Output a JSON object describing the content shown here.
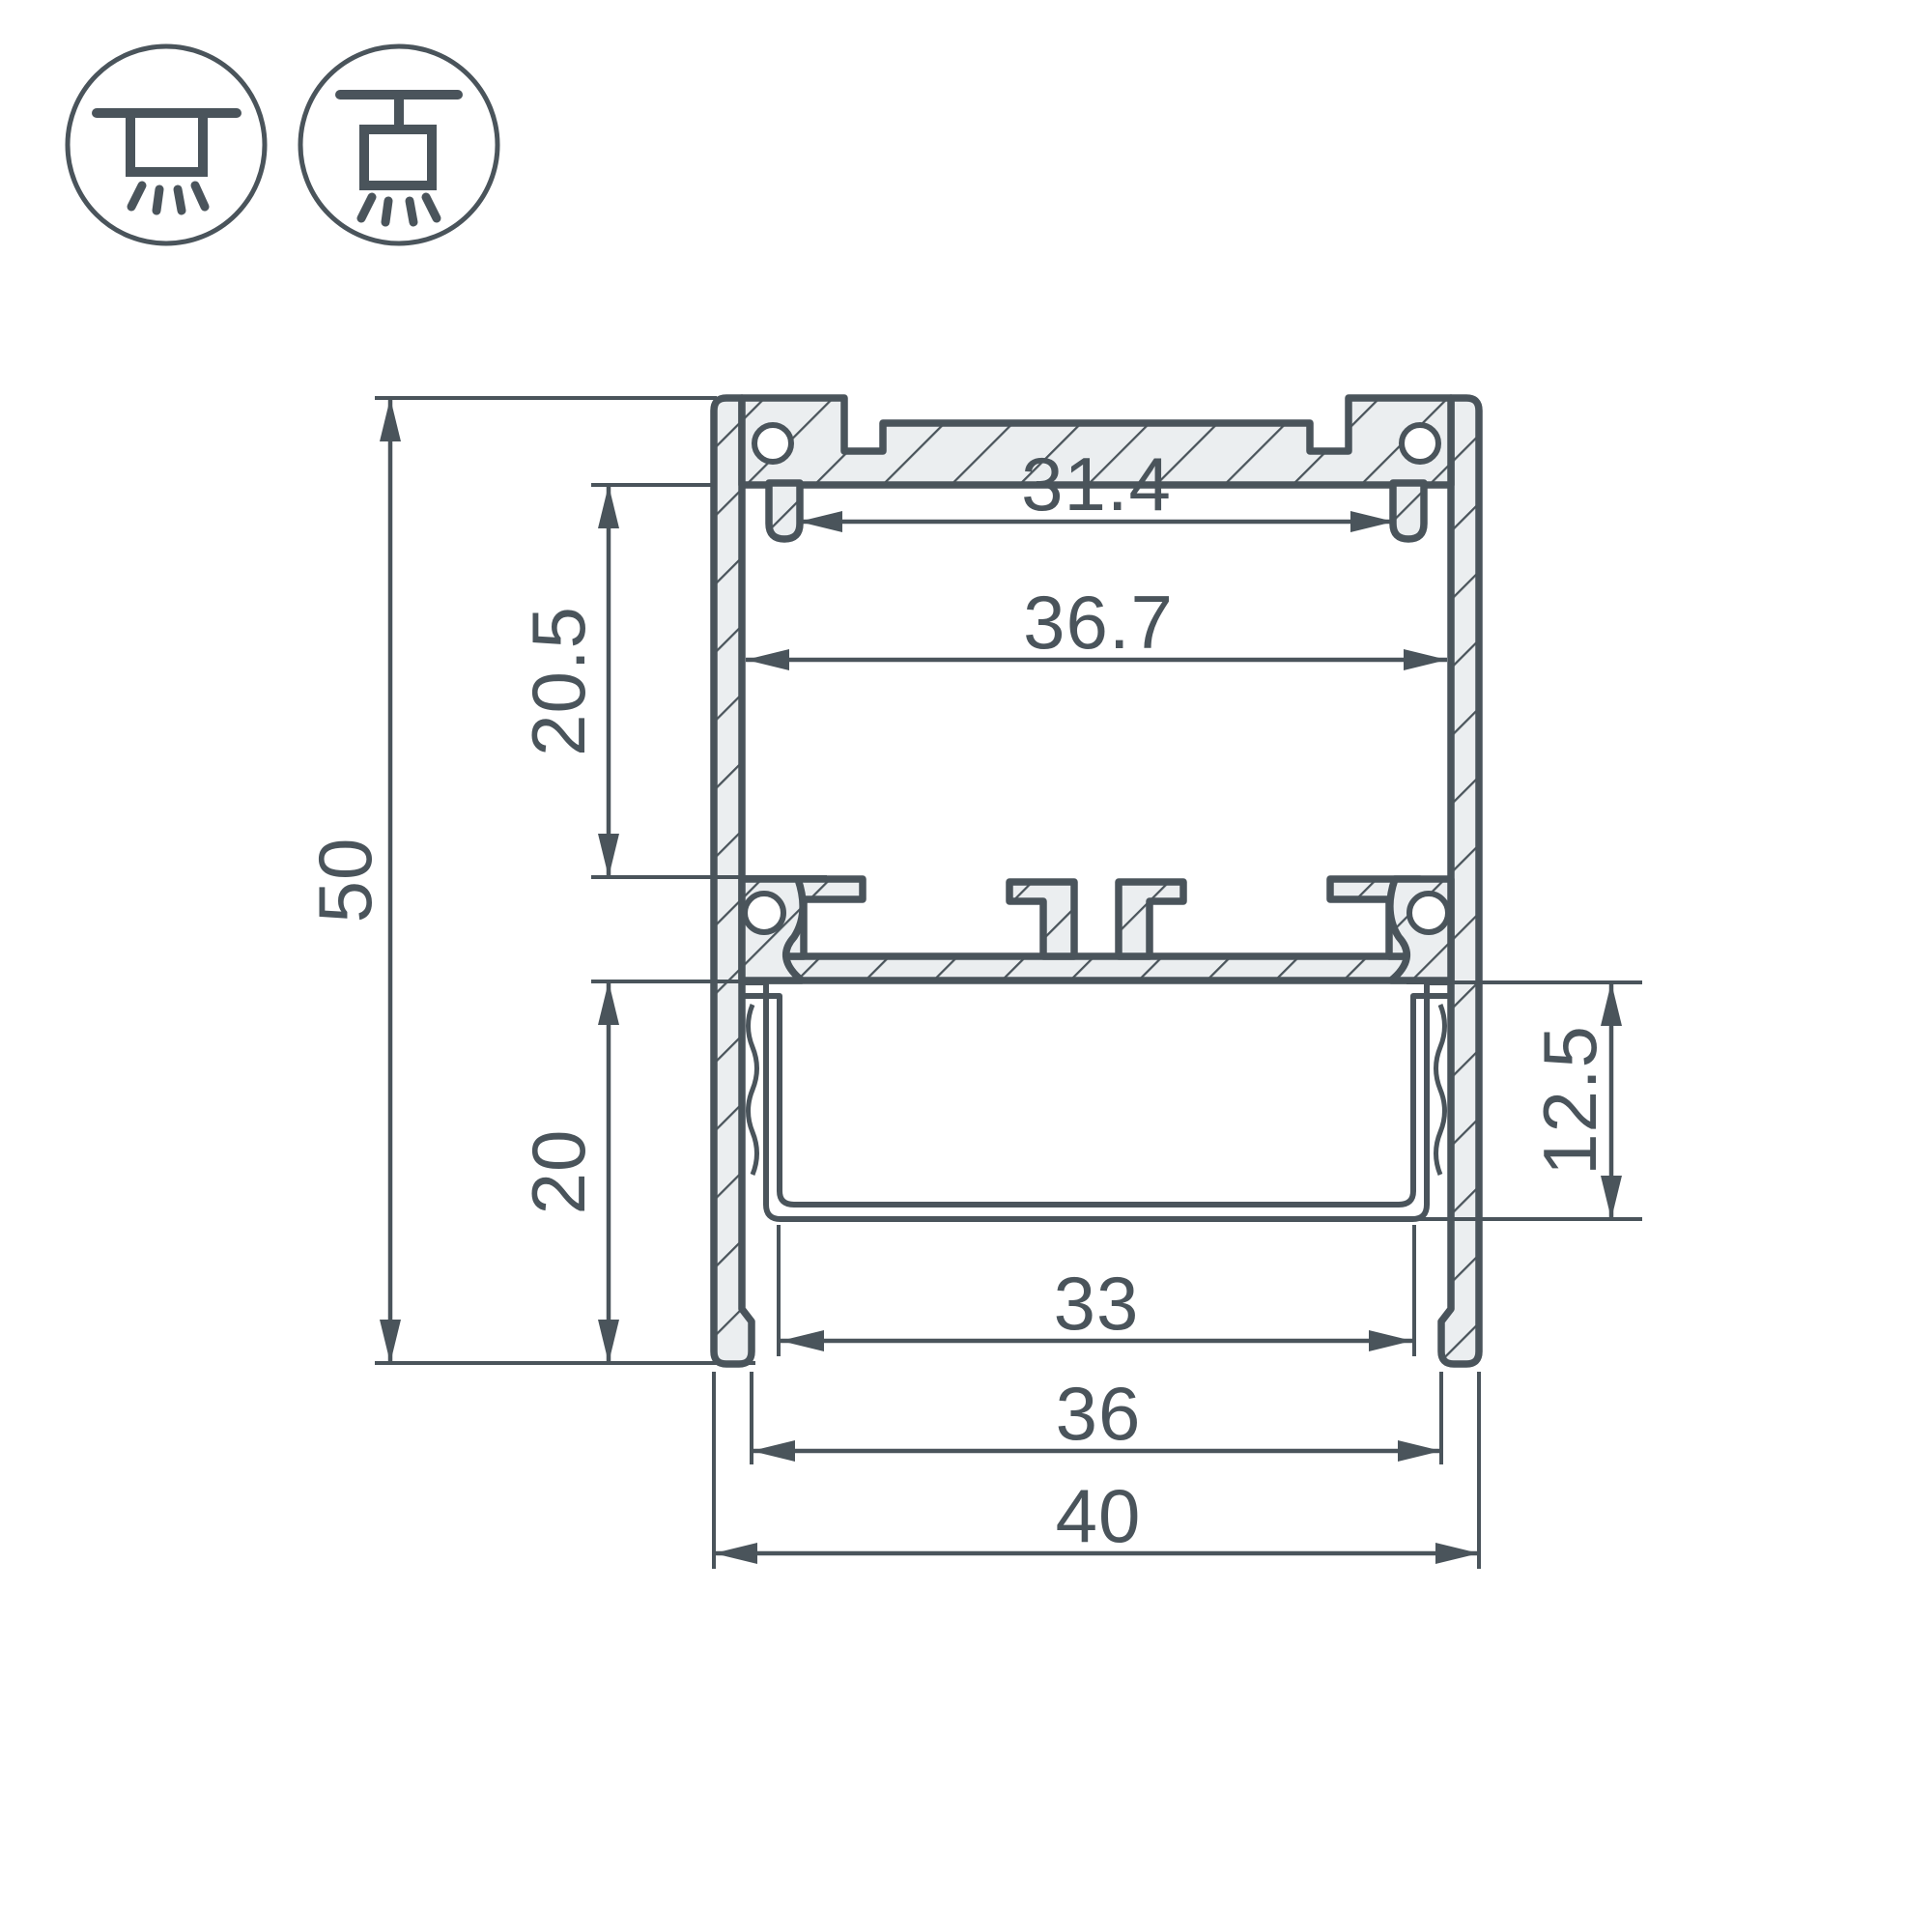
{
  "drawing": {
    "type": "led-profile-cross-section-technical-drawing",
    "colors": {
      "line": "#4a545b",
      "aluminum_fill": "#ebeef0",
      "background": "#ffffff"
    },
    "icons": [
      {
        "name": "ceiling-surface-mount-icon"
      },
      {
        "name": "ceiling-pendant-mount-icon"
      }
    ],
    "dimensions": {
      "overall_height": "50",
      "top_chamber_height": "20.5",
      "bottom_chamber_height": "20",
      "top_inner_width": "31.4",
      "inner_width": "36.7",
      "diffuser_depth": "12.5",
      "diffuser_inner_width": "33",
      "bottom_opening_width": "36",
      "overall_width": "40"
    }
  }
}
